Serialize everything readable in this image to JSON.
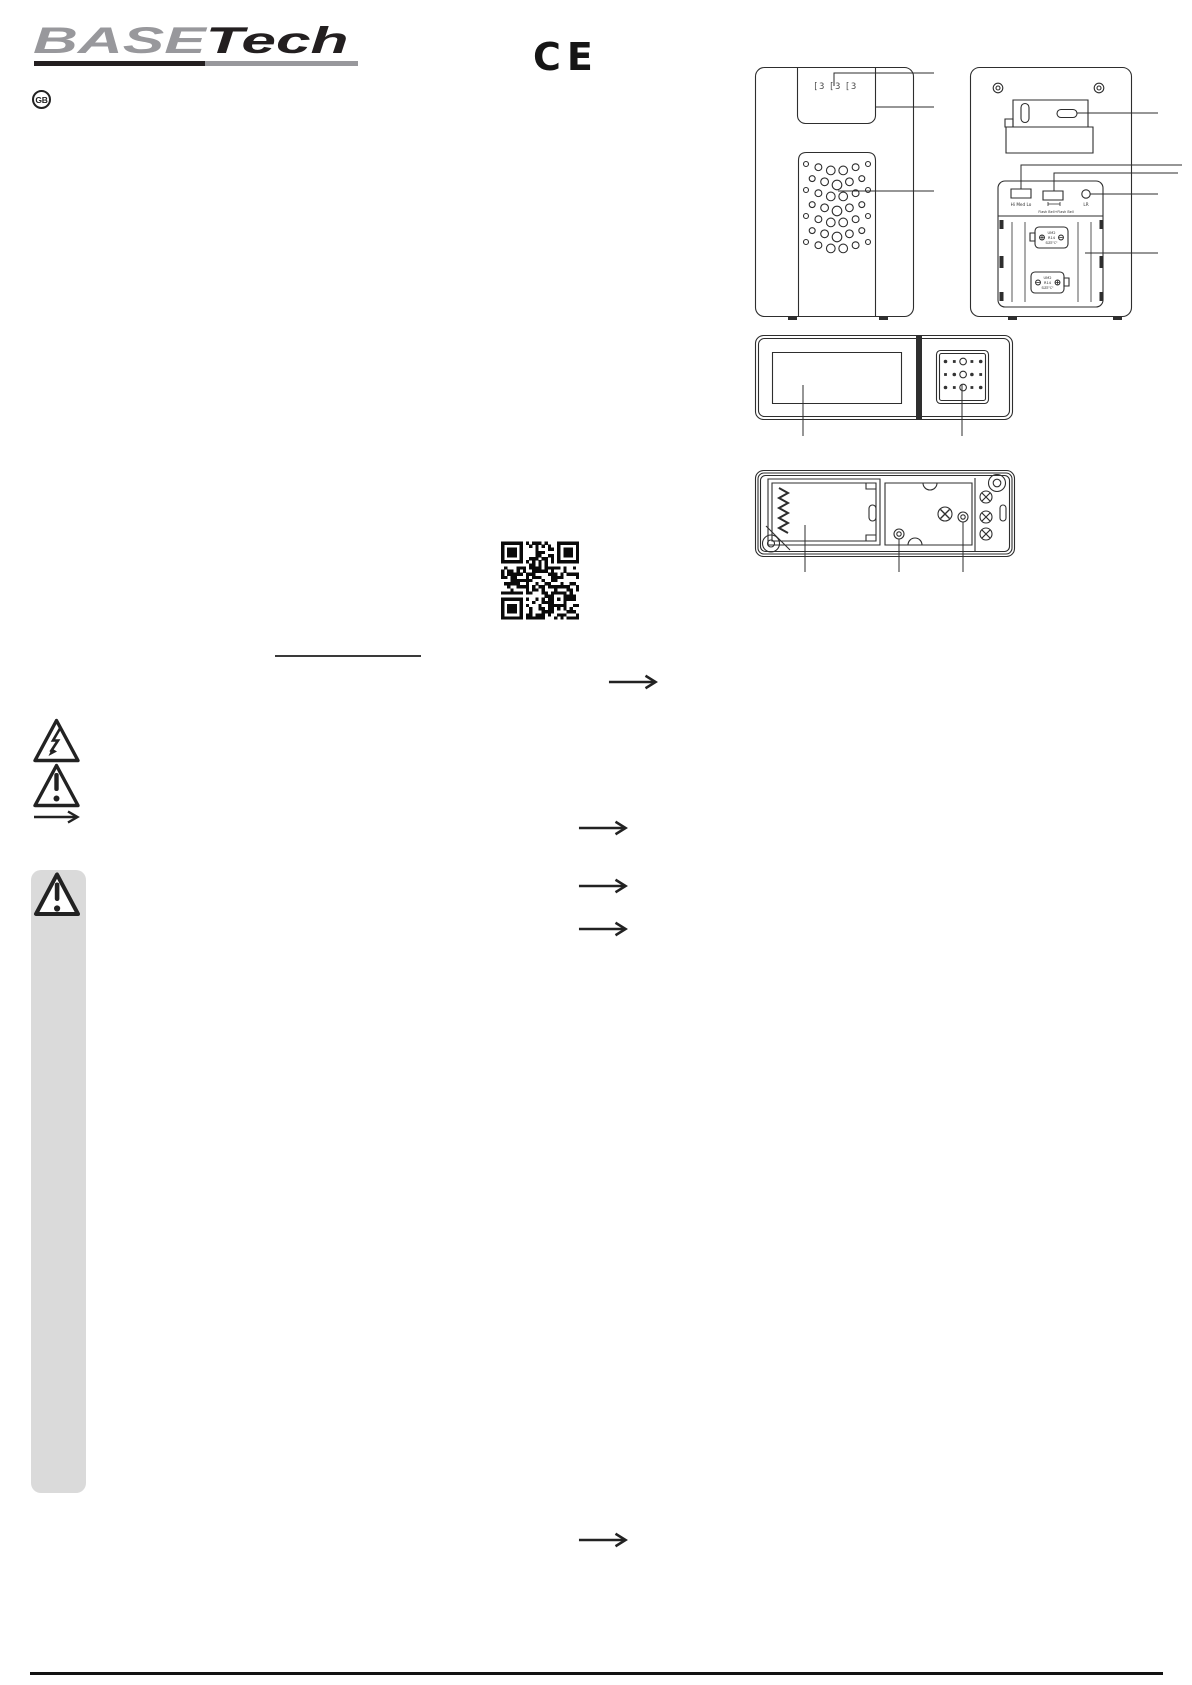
{
  "page": {
    "width": 1192,
    "height": 1685,
    "background": "#ffffff"
  },
  "colors": {
    "brand_gray": "#98989c",
    "ink_black": "#231f20",
    "line_art": "#2e2e2e",
    "sidebar_gray": "#dadada"
  },
  "header": {
    "brand_part1": "BASE",
    "brand_part2": "Tech",
    "language_badge": "GB",
    "ce_mark": "CE"
  },
  "diagrams": {
    "receiver_front": {
      "display_text": "[3 [3 [3"
    },
    "receiver_back": {
      "volume_switch_label": "Hi Med Lo",
      "mode_switch_label": "Flash Bell+Flash Bell",
      "learn_button_label": "LR",
      "battery1_label": [
        "UM2",
        "R14",
        "SIZE\"C\""
      ],
      "battery2_label": [
        "UM2",
        "R14",
        "SIZE\"C\""
      ]
    }
  },
  "icons": {
    "electric_hazard": "triangle-lightning",
    "general_warning": "triangle-exclamation",
    "note_arrow": "long-right-arrow",
    "important_note": "triangle-exclamation-large",
    "qr": "qr-code"
  }
}
